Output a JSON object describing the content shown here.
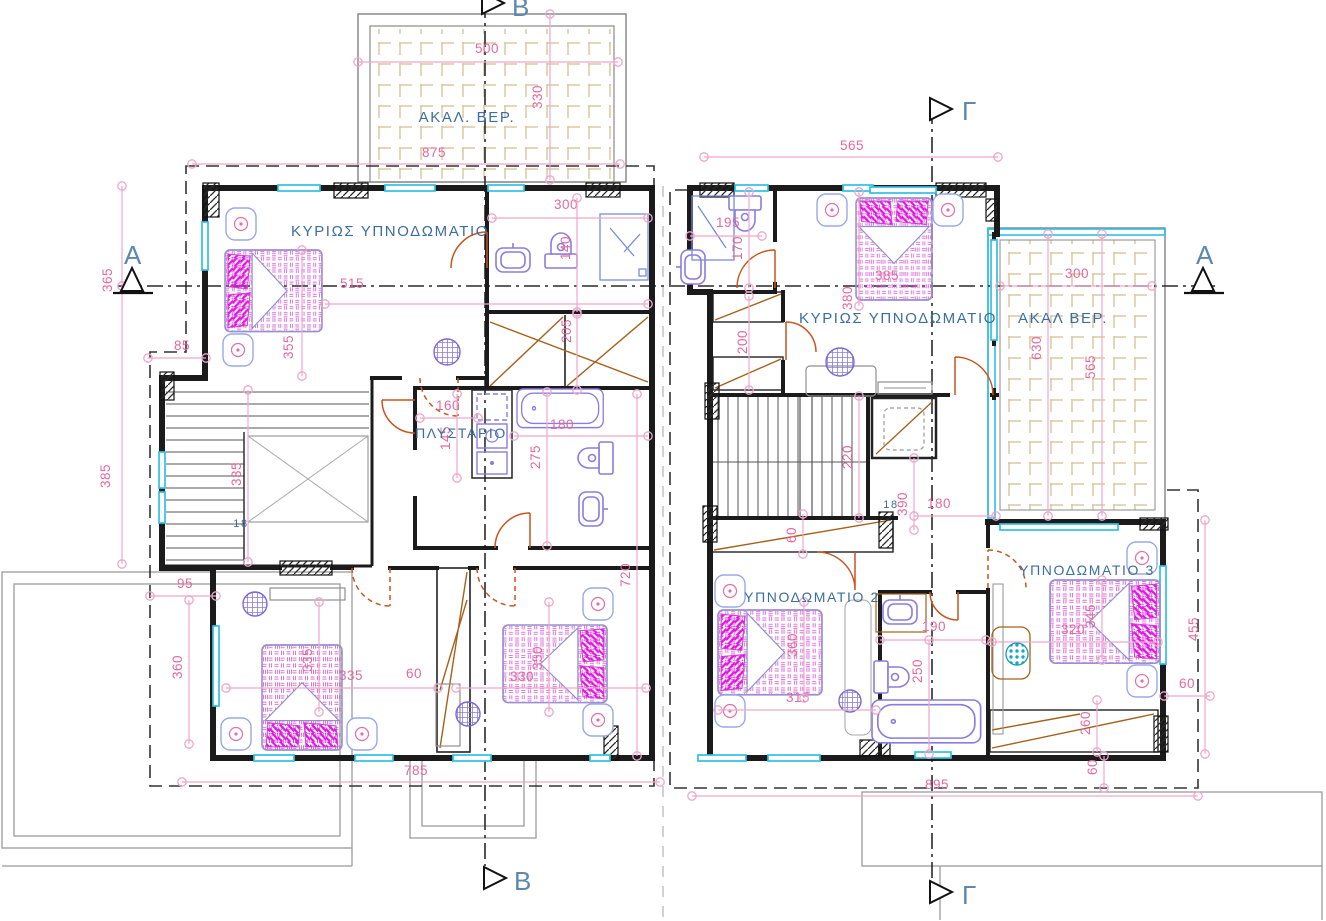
{
  "meta": {
    "width": 1326,
    "height": 921,
    "drawing_kind": "floor-plan"
  },
  "colors": {
    "dimension": "#e3699f",
    "dimension_line": "#efa6cb",
    "room_label": "#3c6e9f",
    "section_letter": "#5b87b0",
    "wall": "#1b1b1b",
    "window": "#2fc0e4",
    "tile": "#dcc8a2",
    "door": "#c8551e",
    "closet_wood": "#a4621c",
    "fixture": "#8a7ce0",
    "bed_accent": "#d935d9",
    "ground_line": "#9b9b9b"
  },
  "text_labels": [
    {
      "t": "ΑΚΑΛ. ΒΕΡ.",
      "x": 467,
      "y": 122,
      "s": 15
    },
    {
      "t": "ΚΥΡΙΩΣ  ΥΠΝΟΔΩΜΑΤΙΟ",
      "x": 390,
      "y": 236,
      "s": 15
    },
    {
      "t": "ΚΥΡΙΩΣ  ΥΠΝΟΔΩΜΑΤΙΟ",
      "x": 898,
      "y": 323,
      "s": 15
    },
    {
      "t": "ΑΚΑΛ ΒΕΡ.",
      "x": 1063,
      "y": 323,
      "s": 15
    },
    {
      "t": "ΠΛΥΣΤΑΡΙΟ",
      "x": 461,
      "y": 438,
      "s": 14
    },
    {
      "t": "ΥΠΝΟΔΩΜΑΤΙΟ  2",
      "x": 812,
      "y": 602,
      "s": 14
    },
    {
      "t": "ΥΠΝΟΔΩΜΑΤΙΟ  3",
      "x": 1087,
      "y": 575,
      "s": 14
    },
    {
      "t": "18",
      "x": 241,
      "y": 527,
      "s": 11
    },
    {
      "t": "18",
      "x": 891,
      "y": 508,
      "s": 11
    }
  ],
  "sections": [
    {
      "letter": "B",
      "shape": "right",
      "tx": 482,
      "ty": -8,
      "lx": 512,
      "ly": 16
    },
    {
      "letter": "Γ",
      "shape": "right",
      "tx": 930,
      "ty": 98,
      "lx": 962,
      "ly": 120
    },
    {
      "letter": "A",
      "shape": "up",
      "tx": 121,
      "ty": 291,
      "lx": 124,
      "ly": 264
    },
    {
      "letter": "A",
      "shape": "up",
      "tx": 1192,
      "ty": 291,
      "lx": 1196,
      "ly": 264
    },
    {
      "letter": "B",
      "shape": "right",
      "tx": 484,
      "ty": 867,
      "lx": 514,
      "ly": 890
    },
    {
      "letter": "Γ",
      "shape": "right",
      "tx": 930,
      "ty": 881,
      "lx": 962,
      "ly": 904
    }
  ],
  "dimensions": [
    {
      "v": "500",
      "x": 487,
      "y": 53,
      "o": "h",
      "l": [
        358,
        62,
        618,
        62
      ]
    },
    {
      "v": "330",
      "x": 542,
      "y": 97,
      "o": "v",
      "l": [
        550,
        14,
        550,
        180
      ]
    },
    {
      "v": "875",
      "x": 434,
      "y": 157,
      "o": "h",
      "l": [
        192,
        164,
        620,
        164
      ]
    },
    {
      "v": "565",
      "x": 852,
      "y": 150,
      "o": "h",
      "l": [
        704,
        157,
        998,
        157
      ]
    },
    {
      "v": "515",
      "x": 352,
      "y": 288,
      "o": "h",
      "l": [
        325,
        304,
        648,
        304
      ]
    },
    {
      "v": "355",
      "x": 293,
      "y": 347,
      "o": "v",
      "l": [
        302,
        250,
        302,
        376
      ]
    },
    {
      "v": "365",
      "x": 112,
      "y": 280,
      "o": "v",
      "l": [
        122,
        186,
        122,
        286
      ]
    },
    {
      "v": "385",
      "x": 110,
      "y": 476,
      "o": "v",
      "l": [
        122,
        286,
        122,
        564
      ]
    },
    {
      "v": "85",
      "x": 182,
      "y": 350,
      "o": "h",
      "l": [
        148,
        358,
        206,
        358
      ]
    },
    {
      "v": "335",
      "x": 241,
      "y": 474,
      "o": "v",
      "l": [
        248,
        390,
        248,
        562
      ]
    },
    {
      "v": "300",
      "x": 566,
      "y": 209,
      "o": "h",
      "l": [
        492,
        218,
        648,
        218
      ]
    },
    {
      "v": "140",
      "x": 570,
      "y": 248,
      "o": "v",
      "l": [
        577,
        198,
        577,
        312
      ]
    },
    {
      "v": "205",
      "x": 571,
      "y": 331,
      "o": "v",
      "l": [
        577,
        314,
        577,
        390
      ]
    },
    {
      "v": "195",
      "x": 728,
      "y": 227,
      "o": "h",
      "l": [
        690,
        236,
        762,
        236
      ]
    },
    {
      "v": "170",
      "x": 742,
      "y": 248,
      "o": "v",
      "l": [
        749,
        192,
        749,
        288
      ]
    },
    {
      "v": "200",
      "x": 747,
      "y": 342,
      "o": "v",
      "l": [
        749,
        296,
        749,
        390
      ]
    },
    {
      "v": "385",
      "x": 887,
      "y": 280,
      "o": "h"
    },
    {
      "v": "380",
      "x": 852,
      "y": 298,
      "o": "v",
      "l": [
        859,
        192,
        859,
        306
      ]
    },
    {
      "v": "300",
      "x": 1077,
      "y": 278,
      "o": "h",
      "l": [
        1000,
        286,
        1152,
        286
      ]
    },
    {
      "v": "630",
      "x": 1041,
      "y": 348,
      "o": "v",
      "l": [
        1048,
        234,
        1048,
        516
      ]
    },
    {
      "v": "565",
      "x": 1095,
      "y": 367,
      "o": "v",
      "l": [
        1102,
        234,
        1102,
        516
      ]
    },
    {
      "v": "160",
      "x": 448,
      "y": 410,
      "o": "h",
      "l": [
        420,
        418,
        478,
        418
      ]
    },
    {
      "v": "145",
      "x": 450,
      "y": 438,
      "o": "v",
      "l": [
        457,
        394,
        457,
        478
      ]
    },
    {
      "v": "275",
      "x": 540,
      "y": 457,
      "o": "v",
      "l": [
        547,
        392,
        547,
        546
      ]
    },
    {
      "v": "180",
      "x": 562,
      "y": 429,
      "o": "h",
      "l": [
        514,
        436,
        648,
        436
      ]
    },
    {
      "v": "95",
      "x": 185,
      "y": 588,
      "o": "h",
      "l": [
        150,
        596,
        216,
        596
      ]
    },
    {
      "v": "360",
      "x": 182,
      "y": 667,
      "o": "v",
      "l": [
        189,
        600,
        189,
        744
      ]
    },
    {
      "v": "335",
      "x": 312,
      "y": 660,
      "o": "v",
      "l": [
        319,
        602,
        319,
        712
      ]
    },
    {
      "v": "335",
      "x": 351,
      "y": 680,
      "o": "h",
      "l": [
        226,
        688,
        438,
        688
      ]
    },
    {
      "v": "60",
      "x": 414,
      "y": 678,
      "o": "h"
    },
    {
      "v": "330",
      "x": 522,
      "y": 681,
      "o": "h",
      "l": [
        456,
        688,
        646,
        688
      ]
    },
    {
      "v": "350",
      "x": 542,
      "y": 658,
      "o": "v",
      "l": [
        549,
        602,
        549,
        712
      ]
    },
    {
      "v": "720",
      "x": 630,
      "y": 575,
      "o": "v",
      "l": [
        637,
        394,
        637,
        756
      ]
    },
    {
      "v": "60",
      "x": 796,
      "y": 535,
      "o": "v",
      "l": [
        803,
        514,
        803,
        554
      ]
    },
    {
      "v": "390",
      "x": 907,
      "y": 504,
      "o": "v",
      "l": [
        914,
        458,
        914,
        530
      ]
    },
    {
      "v": "180",
      "x": 939,
      "y": 508,
      "o": "h",
      "l": [
        914,
        516,
        996,
        516
      ]
    },
    {
      "v": "220",
      "x": 852,
      "y": 457,
      "o": "v",
      "l": [
        859,
        396,
        859,
        518
      ]
    },
    {
      "v": "190",
      "x": 934,
      "y": 631,
      "o": "h",
      "l": [
        880,
        640,
        986,
        640
      ]
    },
    {
      "v": "250",
      "x": 922,
      "y": 671,
      "o": "v",
      "l": [
        929,
        640,
        929,
        754
      ]
    },
    {
      "v": "315",
      "x": 798,
      "y": 702,
      "o": "h",
      "l": [
        718,
        710,
        876,
        710
      ]
    },
    {
      "v": "360",
      "x": 797,
      "y": 645,
      "o": "v",
      "l": [
        804,
        602,
        804,
        698
      ]
    },
    {
      "v": "320",
      "x": 1073,
      "y": 634,
      "o": "h",
      "l": [
        992,
        642,
        1158,
        642
      ]
    },
    {
      "v": "345",
      "x": 1095,
      "y": 616,
      "o": "v",
      "l": [
        1102,
        580,
        1102,
        660
      ]
    },
    {
      "v": "455",
      "x": 1198,
      "y": 629,
      "o": "v",
      "l": [
        1205,
        520,
        1205,
        754
      ]
    },
    {
      "v": "60",
      "x": 1187,
      "y": 688,
      "o": "h",
      "l": [
        1164,
        696,
        1210,
        696
      ]
    },
    {
      "v": "260",
      "x": 1090,
      "y": 723,
      "o": "v",
      "l": [
        1097,
        700,
        1097,
        752
      ]
    },
    {
      "v": "60",
      "x": 1097,
      "y": 767,
      "o": "v",
      "l": [
        1104,
        756,
        1104,
        788
      ]
    },
    {
      "v": "895",
      "x": 937,
      "y": 789,
      "o": "h",
      "l": [
        692,
        796,
        1198,
        796
      ]
    },
    {
      "v": "785",
      "x": 416,
      "y": 775,
      "o": "h",
      "l": [
        182,
        782,
        660,
        782
      ]
    }
  ]
}
